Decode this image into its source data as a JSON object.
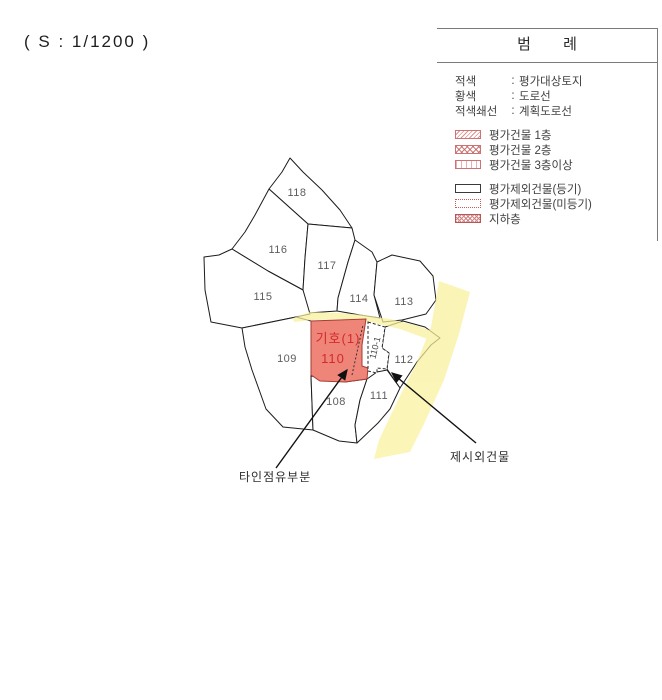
{
  "scale_label": "( S : 1/1200 )",
  "legend": {
    "title": "범 례",
    "separator": ":",
    "color_keys": [
      {
        "term": "적색",
        "desc": "평가대상토지"
      },
      {
        "term": "황색",
        "desc": "도로선"
      },
      {
        "term": "적색쇄선",
        "desc": "계획도로선"
      }
    ],
    "building_keys": [
      {
        "swatch": "hatch-diagonal-swatch",
        "label": "평가건물 1층"
      },
      {
        "swatch": "hatch-cross-swatch",
        "label": "평가건물 2층"
      },
      {
        "swatch": "hatch-arc-swatch",
        "label": "평가건물 3층이상"
      }
    ],
    "exclusion_keys": [
      {
        "swatch": "outline-solid-swatch",
        "label": "평가제외건물(등기)"
      },
      {
        "swatch": "outline-dotted-swatch",
        "label": "평가제외건물(미등기)"
      },
      {
        "swatch": "hatch-dense-swatch",
        "label": "지하층"
      }
    ]
  },
  "map": {
    "parcels": [
      {
        "id": "118"
      },
      {
        "id": "116"
      },
      {
        "id": "117"
      },
      {
        "id": "115"
      },
      {
        "id": "114"
      },
      {
        "id": "113"
      },
      {
        "id": "109"
      },
      {
        "id": "112"
      },
      {
        "id": "108"
      },
      {
        "id": "111"
      }
    ],
    "subject": {
      "marker": "기호(1)",
      "number": "110",
      "annex": "110-1"
    },
    "callouts": [
      {
        "label": "타인점유부분"
      },
      {
        "label": "제시외건물"
      }
    ]
  },
  "colors": {
    "subject_fill": "#ef8478",
    "subject_stroke": "#a63c32",
    "subject_text": "#d42a2a",
    "road_fill": "#faf19c",
    "outline": "#1c1c1c"
  }
}
